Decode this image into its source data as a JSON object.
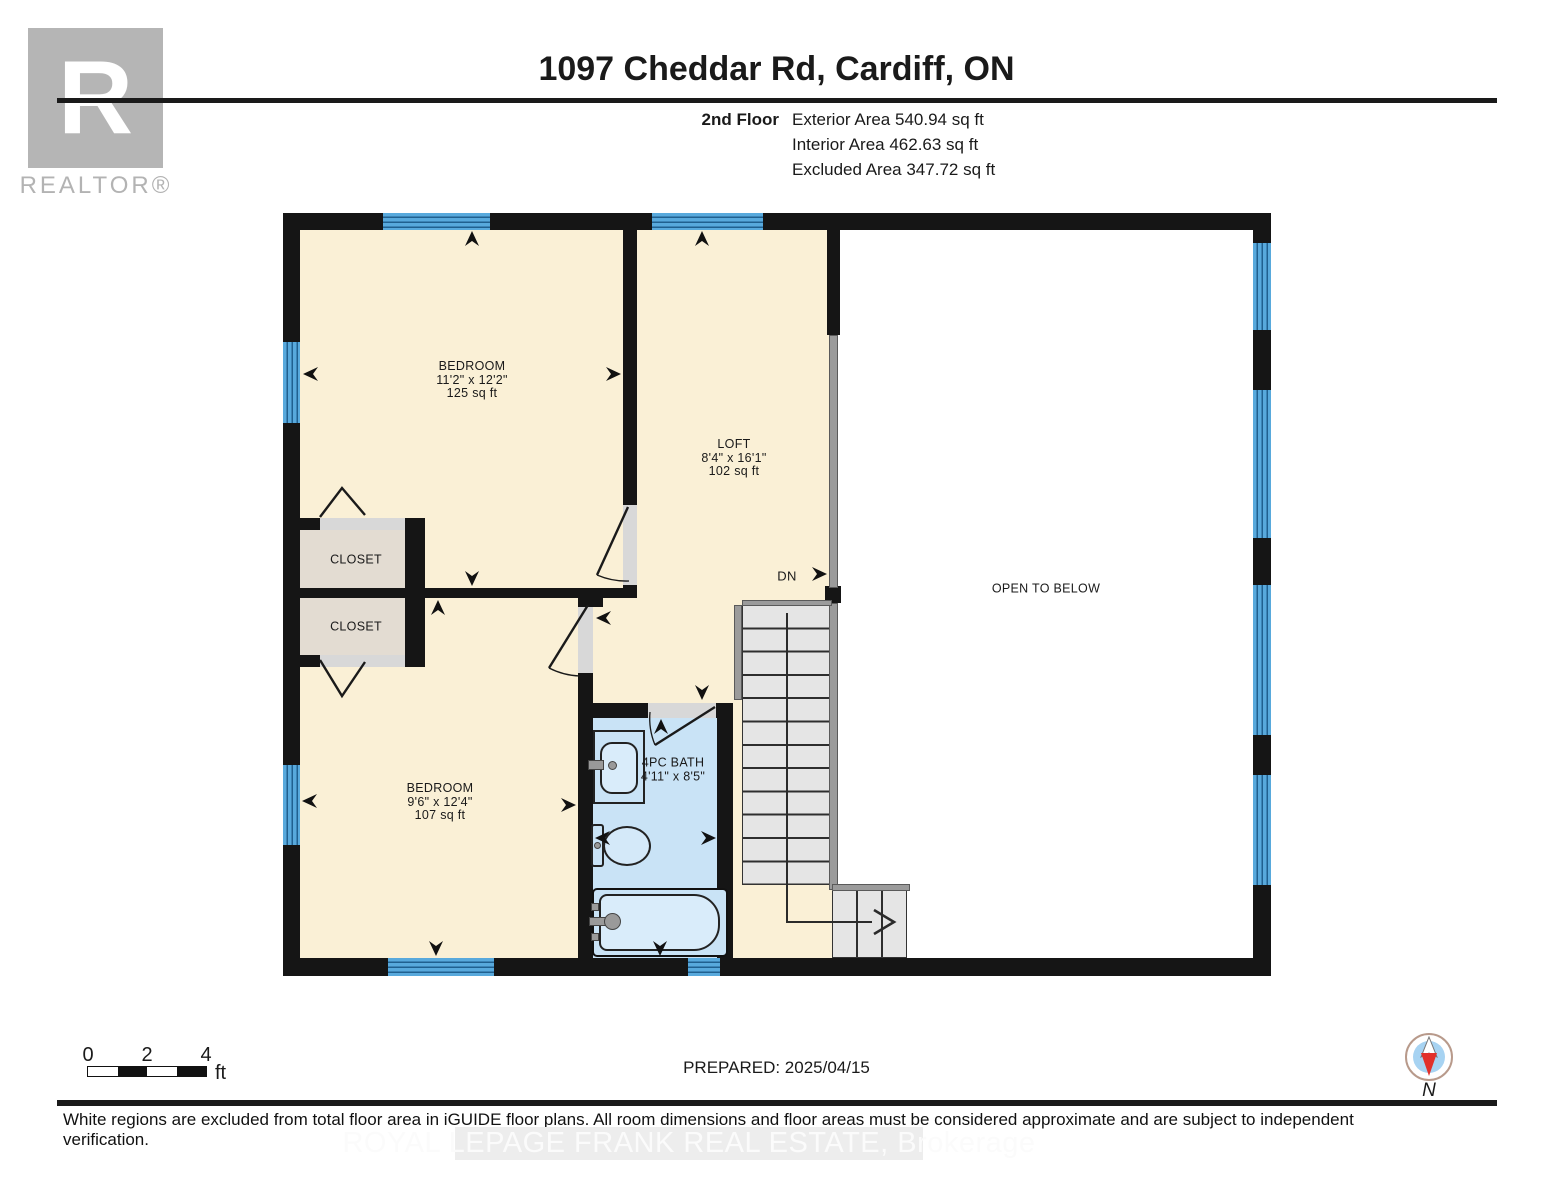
{
  "header": {
    "logo_letter": "R",
    "logo_wordmark": "REALTOR®",
    "title": "1097 Cheddar Rd, Cardiff, ON",
    "floor_label": "2nd Floor",
    "area_lines": [
      "Exterior Area 540.94 sq ft",
      "Interior Area 462.63 sq ft",
      "Excluded Area 347.72 sq ft"
    ]
  },
  "rooms": {
    "bedroom1": {
      "name": "BEDROOM",
      "dims": "11'2\" x 12'2\"",
      "area": "125 sq ft"
    },
    "loft": {
      "name": "LOFT",
      "dims": "8'4\" x 16'1\"",
      "area": "102 sq ft"
    },
    "bedroom2": {
      "name": "BEDROOM",
      "dims": "9'6\" x 12'4\"",
      "area": "107 sq ft"
    },
    "bath": {
      "name": "4PC BATH",
      "dims": "4'11\" x 8'5\""
    },
    "closet1": {
      "name": "CLOSET"
    },
    "closet2": {
      "name": "CLOSET"
    },
    "open_to_below": "OPEN TO BELOW",
    "stairs_direction": "DN"
  },
  "scalebar": {
    "t0": "0",
    "t2": "2",
    "t4": "4",
    "unit": "ft"
  },
  "footer": {
    "prepared": "PREPARED: 2025/04/15",
    "compass_north": "N",
    "disclaimer": "White regions are excluded from total floor area in iGUIDE floor plans. All room dimensions and floor areas must be considered approximate and are subject to independent verification.",
    "watermark": "ROYAL LEPAGE FRANK REAL ESTATE, Brokerage"
  },
  "colors": {
    "floor_cream": "#faf0d6",
    "closet_tan": "#e3dcd2",
    "bath_blue": "#c9e3f6",
    "window_blue": "#58a9dc",
    "wall_black": "#151515",
    "railing_gray": "#9b9b9b",
    "stairs_gray": "#e5e5e5",
    "compass_red": "#e2302a",
    "compass_blue": "#a7d3f2"
  }
}
